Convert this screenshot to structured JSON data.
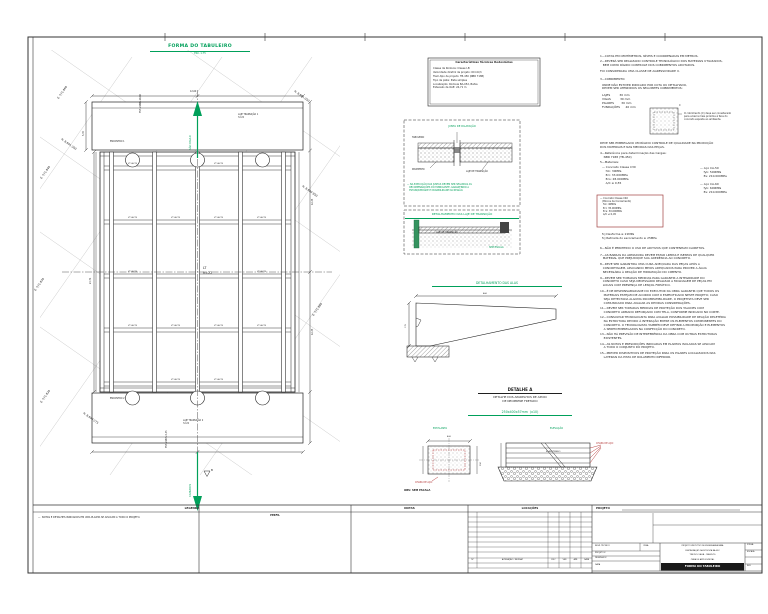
{
  "sheet": {
    "plan_title": "FORMA DO TABULEIRO",
    "plan_scale": "ESC. 1:75"
  },
  "plan": {
    "labels": [
      {
        "n": "coord-e-571860",
        "t": "E. 571.860",
        "x": 57,
        "y": 98,
        "r": -55,
        "fs": 2.8
      },
      {
        "n": "coord-e-571840",
        "t": "E. 571.840",
        "x": 40,
        "y": 178,
        "r": -55,
        "fs": 2.8
      },
      {
        "n": "coord-e-571830",
        "t": "E. 571.830",
        "x": 34,
        "y": 290,
        "r": -55,
        "fs": 2.8
      },
      {
        "n": "coord-e-571820",
        "t": "E. 571.820",
        "x": 40,
        "y": 402,
        "r": -55,
        "fs": 2.8
      },
      {
        "n": "coord-e-571880",
        "t": "E. 571.880",
        "x": 312,
        "y": 315,
        "r": -55,
        "fs": 2.8
      },
      {
        "n": "coord-n-8601300",
        "t": "N. 8.601.300",
        "x": 62,
        "y": 138,
        "r": 35,
        "fs": 2.8
      },
      {
        "n": "coord-n-8601050",
        "t": "N. 8.601.050",
        "x": 295,
        "y": 90,
        "r": 35,
        "fs": 2.8
      },
      {
        "n": "coord-n-8600950",
        "t": "N. 8.600.950",
        "x": 303,
        "y": 185,
        "r": 35,
        "fs": 2.8
      },
      {
        "n": "coord-n-8600275",
        "t": "N. 8.600.275",
        "x": 84,
        "y": 412,
        "r": 35,
        "fs": 2.8
      },
      {
        "n": "beam-label",
        "t": "VT 40/75",
        "x": 128,
        "y": 163,
        "fs": 2.0
      },
      {
        "n": "beam-label",
        "t": "VT 40/75",
        "x": 214,
        "y": 163,
        "fs": 2.0
      },
      {
        "n": "beam-label",
        "t": "VT 40/75",
        "x": 128,
        "y": 217,
        "fs": 2.0
      },
      {
        "n": "beam-label",
        "t": "VT 40/75",
        "x": 171,
        "y": 217,
        "fs": 2.0
      },
      {
        "n": "beam-label",
        "t": "VT 40/75",
        "x": 214,
        "y": 217,
        "fs": 2.0
      },
      {
        "n": "beam-label",
        "t": "VT 40/75",
        "x": 257,
        "y": 217,
        "fs": 2.0
      },
      {
        "n": "beam-label",
        "t": "VT 40/75",
        "x": 128,
        "y": 271,
        "fs": 2.0
      },
      {
        "n": "beam-label",
        "t": "VT 40/75",
        "x": 257,
        "y": 271,
        "fs": 2.0
      },
      {
        "n": "beam-label",
        "t": "VT 40/75",
        "x": 128,
        "y": 325,
        "fs": 2.0
      },
      {
        "n": "beam-label",
        "t": "VT 40/75",
        "x": 171,
        "y": 325,
        "fs": 2.0
      },
      {
        "n": "beam-label",
        "t": "VT 40/75",
        "x": 214,
        "y": 325,
        "fs": 2.0
      },
      {
        "n": "beam-label",
        "t": "VT 40/75",
        "x": 257,
        "y": 325,
        "fs": 2.0
      },
      {
        "n": "beam-label",
        "t": "VT 40/75",
        "x": 171,
        "y": 379,
        "fs": 2.0
      },
      {
        "n": "beam-label",
        "t": "VT 40/75",
        "x": 214,
        "y": 379,
        "fs": 2.0
      },
      {
        "n": "panel-label",
        "t": "LT\nh=22",
        "x": 203,
        "y": 266,
        "fs": 3.4
      },
      {
        "n": "slab1-label",
        "t": "LAJE TRANSIÇÃO 1\nh=22",
        "x": 238,
        "y": 114,
        "fs": 2.2
      },
      {
        "n": "encontro1-label",
        "t": "ENCONTRO 1",
        "x": 110,
        "y": 141,
        "fs": 2.2
      },
      {
        "n": "encontro2-label",
        "t": "ENCONTRO 2",
        "x": 110,
        "y": 398,
        "fs": 2.2
      },
      {
        "n": "slab2-label",
        "t": "LAJE TRANSIÇÃO 2\nh=22",
        "x": 183,
        "y": 420,
        "fs": 2.2
      },
      {
        "n": "est-start-label",
        "t": "EST. 2188+10,06",
        "x": 140,
        "y": 113,
        "r": -90,
        "fs": 2.2
      },
      {
        "n": "est-end-label",
        "t": "EST. 2187+5,35",
        "x": 166,
        "y": 448,
        "r": -90,
        "fs": 2.2
      },
      {
        "n": "direction-north-label",
        "t": "SÃO PAULO",
        "x": 189,
        "y": 150,
        "r": -90,
        "fs": 2.6,
        "c": "g"
      },
      {
        "n": "direction-south-label",
        "t": "CANUDOS",
        "x": 189,
        "y": 497,
        "r": -90,
        "fs": 2.6,
        "c": "g"
      },
      {
        "n": "dim-width",
        "t": "12,60",
        "x": 190,
        "y": 90.5,
        "fs": 2.2
      },
      {
        "n": "dim-span-left",
        "t": "24,71",
        "x": 90,
        "y": 284,
        "r": -90,
        "fs": 2.2
      },
      {
        "n": "dim-slab-left",
        "t": "5,35",
        "x": 83,
        "y": 136,
        "r": -90,
        "fs": 2.2
      },
      {
        "n": "dim-span-r1",
        "t": "12,35",
        "x": 312,
        "y": 205,
        "r": -90,
        "fs": 2.2
      },
      {
        "n": "dim-span-r2",
        "t": "12,35",
        "x": 312,
        "y": 335,
        "r": -90,
        "fs": 2.2
      },
      {
        "n": "point-b-label",
        "t": "B",
        "x": 211,
        "y": 469,
        "fs": 2.8
      }
    ]
  },
  "tech_box": {
    "title": "Características Técnicas Rodoviárias",
    "lines": [
      "Classe da Rodovia: Classe I-B",
      "Velocidade diretriz de projeto: 60 km/h",
      "Trem-tipo de projeto: TB-450 (NBR 7188)",
      "Tipo de pista: Pista simples",
      "Localização: Rodovia BA-052, Bahia",
      "Extensão da OAE: 24,71 m"
    ]
  },
  "joint": {
    "title": "JUNTA DE DILATAÇÃO",
    "label_tabuleiro": "TABULEIRO",
    "label_pavimento": "PAVIMENTO",
    "label_laje": "LAJE DE TRANSIÇÃO",
    "note": "— NA EXECUÇÃO DAS JUNTAS DEVEM SER SEGUIDAS AS\n   RECOMENDAÇÕES DO FABRICANTE, GARANTINDO A\n   ESTANQUEIDADE E DURABILIDADE DA REGIÃO."
  },
  "transition": {
    "title": "DETALHAMENTO DAS LAJE DE TRANSIÇÃO",
    "slab_label": "LAJE DE TRANSIÇÃO",
    "no_scale": "SEM ESCALA"
  },
  "wing": {
    "title": "DETALHAMENTO DAS ALAS",
    "dim_top": "460",
    "dim_left": "175"
  },
  "detail_a": {
    "title": "DETALHE A",
    "subtitle": "DETALHE DOS APARELHOS DE APOIO\nDE NEOPRENE FRETADO",
    "size": "250x400x57mm  (x10)",
    "plan_label": "EM PLANTA",
    "elev_label": "ELEVAÇÃO",
    "steel_label": "CHAPA DE AÇO",
    "elastomer_label": "ELASTÔMERO",
    "obs": "OBS: SEM ESCALA",
    "dim_w": "400",
    "dim_h": "250"
  },
  "notes": {
    "blocks": [
      {
        "t": "1—COTAS EM CENTÍMETROS, NÍVEIS E COORDENADAS EM METROS.",
        "x": 600,
        "y": 55
      },
      {
        "t": "2—DEVERÁ SER REALIZADO CONTROLE TECNOLÓGICO DOS MATERIAIS UTILIZADOS,\n   BEM COMO RÍGIDO CONTROLE DOS COBRIMENTOS ADOTADOS.",
        "x": 600,
        "y": 60
      },
      {
        "t": "FOI CONSIDERADA UMA CLASSE DE AGRESSIVIDADE II.",
        "x": 600,
        "y": 70
      },
      {
        "t": "3—COBRIMENTO:",
        "x": 600,
        "y": 78
      },
      {
        "t": "ONDE NÃO ESTIVER INDICADO POR COTA OU DETALHADO,\nDEVEM SER ATENDIDOS OS SEGUINTES COBRIMENTOS:",
        "x": 602,
        "y": 83.5
      },
      {
        "t": "LAJES          30 mm\nVIGAS          30 mm\nPILARES        30 mm\nFUNDAÇÕES      40 mm",
        "x": 602,
        "y": 94
      },
      {
        "t": "O cobrimento (C) deve ser considerado\npara a barra mais próxima à face do\nconcreto exposta ao ambiente.",
        "x": 684,
        "y": 112,
        "fs": 2.4
      },
      {
        "t": "C",
        "x": 679,
        "y": 104,
        "fs": 2.4
      },
      {
        "t": "DEVE SER EMPREGADO UM RÍGIDO CONTROLE DE QUALIDADE NA PRODUÇÃO\nDOS MATERIAIS E NAS MEDIDAS DAS PEÇAS.",
        "x": 600,
        "y": 142
      },
      {
        "t": "4—Referência para determinação das Cargas:\n    NBR 7188 (TB-450)",
        "x": 600,
        "y": 152
      },
      {
        "t": "5—Materiais:",
        "x": 600,
        "y": 161
      },
      {
        "t": "— Concreto Classe C30\n    fck: 30MPa\n    Eci: 33.000MPa\n    Ecs: 28.000MPa\n    A/C ≤ 0,55",
        "x": 602,
        "y": 166
      },
      {
        "t": "— Aço CA-50\n    fyk: 500MPa\n    Es: 210.000MPa",
        "x": 700,
        "y": 167
      },
      {
        "t": "— Aço CA-60\n    fyk: 600MPa\n    Es: 210.000MPa",
        "x": 700,
        "y": 183
      },
      {
        "t": "— Concreto Classe C40\n   (Blocos de Coroamento)\n    fck: 40MPa\n    Eci: 35.000MPa\n    Ecs: 30.000MPa\n    A/C ≤ 0,45",
        "x": 600,
        "y": 197,
        "fs": 2.4
      },
      {
        "t": "fcj Desforma ≥ 21MPa\nfcj Retirada do escoramento ≥ 25MPa",
        "x": 602,
        "y": 233
      },
      {
        "t": "6—NÃO É PERMITIDO O USO DE ADITIVOS QUE CONTENHAM CLORETOS.",
        "x": 600,
        "y": 247
      },
      {
        "t": "7—AS BARRAS DA ARMADURA DEVEM ESTAR LIMPAS E ISENTAS DE QUALQUER\n   MATERIAL QUE PREJUDIQUE SUA ADERÊNCIA AO CONCRETO.",
        "x": 600,
        "y": 253.5
      },
      {
        "t": "8—DEVE SER GARANTIDA UMA CURA ADEQUADA DAS PEÇAS APÓS A\n   CONCRETAGEM, APLICANDO MEIOS ADEQUADOS PARA PROVER A ÁGUA\n   NECESSÁRIA À REAÇÃO DE HIDRATAÇÃO DO CIMENTO.",
        "x": 600,
        "y": 263
      },
      {
        "t": "9—DEVEM SER TOMADAS MEDIDAS PARA GARANTIR A INTEGRIDADE DO\n   CONCRETO CASO SEJA NECESSÁRIO REALIZAR A MOLDAGEM DE PEÇAS EM\n   LOCAIS COM PRESENÇA DE LENÇOL FREÁTICO.",
        "x": 600,
        "y": 276.5
      },
      {
        "t": "10—É DE RESPONSABILIDADE DO EXECUTOR DA OBRA GARANTIR QUE TODOS OS\n    MATERIAIS ESTEJAM DE ACORDO COM O ESPECIFICADO NESTE PROJETO; CASO\n    SEJA DETECTADA ALGUMA INCOMPATIBILIDADE, O PROJETISTA DEVE SER\n    COMUNICADO PARA AVALIAR AS DEVIDAS CONSIDERAÇÕES.",
        "x": 600,
        "y": 290
      },
      {
        "t": "11—DEVEM SER TOMADAS MEDIDAS DE PROTEÇÃO DOS TALUDES COM\n    CONCRETO ARMADO REFORÇADO COM TELA, CONFORME INDICADO NO CORTE.",
        "x": 600,
        "y": 307
      },
      {
        "t": "12—CONSULTAR TECNOLOGISTA PARA AVALIAR POSSIBILIDADE DE REAÇÃO DELETÉRIA\n    NA ESTRUTURA DEVIDO À INTERAÇÃO ENTRE OS ELEMENTOS COMPONENTES DO\n    CONCRETO. O TECNOLOGISTA TAMBÉM DEVE DEFINIR A PROPORÇÃO E ELEMENTOS\n    A SEREM EMPREGADOS NA CONFECÇÃO DO CONCRETO.",
        "x": 600,
        "y": 316
      },
      {
        "t": "13—NÃO HÁ PREVISÃO DE INTERFERÊNCIA DA OBRA COM OUTRAS ESTRUTURAS\n    EXISTENTES.",
        "x": 600,
        "y": 333
      },
      {
        "t": "14—AS NOTAS E PRESCRIÇÕES INDICADAS EM PLANTAS ISOLADAS SE APLICAM\n    A TODO O CONJUNTO DO PROJETO.",
        "x": 600,
        "y": 342.5
      },
      {
        "t": "15—PREVER DISPOSITIVOS DE PROTEÇÃO PARA OS PILARES LOCALIZADOS NAS\n    LATERAIS DA PISTA DE ROLAMENTO INFERIOR.",
        "x": 600,
        "y": 352
      }
    ]
  },
  "bottom": {
    "legenda": "LEGENDA",
    "legenda_note": "—  NOTAS E DETALHES INDICADOS EM UMA PLANTA SE APLICAM A TODO O PROJETO.",
    "perfil": "PERFIL",
    "notas": "NOTAS",
    "locacoes": "LOCAÇÕES",
    "projeto": "PROJETO",
    "rev_cols": [
      {
        "t": "Nº",
        "x": 468,
        "w": 9
      },
      {
        "t": "ALTERAÇÃO / REVISÃO",
        "x": 477,
        "w": 71
      },
      {
        "t": "FISC",
        "x": 548,
        "w": 11
      },
      {
        "t": "VER",
        "x": 559,
        "w": 11
      },
      {
        "t": "APR",
        "x": 570,
        "w": 11
      },
      {
        "t": "DATA",
        "x": 581,
        "w": 11
      }
    ],
    "stamp": {
      "resp": "RESP. TÉCNICO",
      "crea": "CREA",
      "projetou": "PROJETOU",
      "desenhou": "DESENHOU",
      "data": "DATA",
      "line1": "PROJETO EXECUTIVO DE ENGENHARIA PARA",
      "line2": "RESTAURAÇÃO DA RODOVIA BA-052",
      "line3": "TRECHO: UAUÁ - CANUDOS",
      "line4": "OBRA DE ARTE ESPECIAL",
      "bar": "FORMA DO TABULEIRO",
      "folha": "FOLHA",
      "escala": "ESCALA",
      "rev": "REV"
    }
  }
}
